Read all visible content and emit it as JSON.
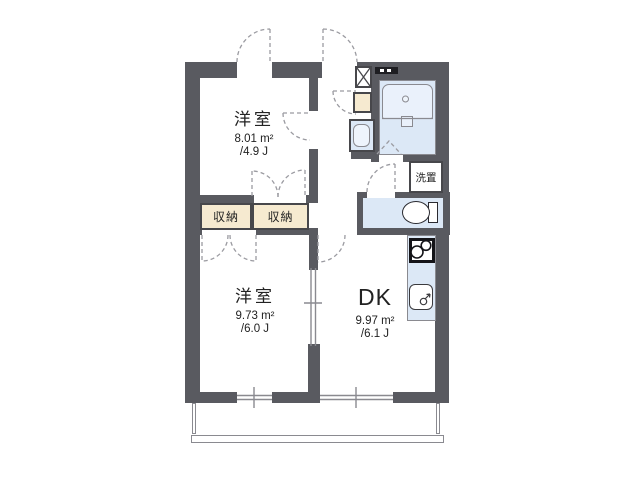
{
  "plan_title": "1DK apartment floor plan",
  "rooms": {
    "bedroom_top": {
      "name": "洋室",
      "area_m2": "8.01 m²",
      "area_jo": "/4.9 J"
    },
    "bedroom_bottom": {
      "name": "洋室",
      "area_m2": "9.73 m²",
      "area_jo": "/6.0 J"
    },
    "dk": {
      "name": "DK",
      "area_m2": "9.97 m²",
      "area_jo": "/6.1 J"
    }
  },
  "closets": {
    "left": "収納",
    "right": "収納"
  },
  "labels": {
    "laundry": "洗置"
  },
  "colors": {
    "wall": "#595a60",
    "wall_line": "#47474b",
    "fixture_blue": "#dce8f6",
    "fixture_blue_light": "#eaf1fb",
    "cream": "#f6ead0",
    "dash": "#9b9ba1",
    "thin_line": "#8a8a90",
    "text": "#222222",
    "black": "#1e1e22"
  }
}
